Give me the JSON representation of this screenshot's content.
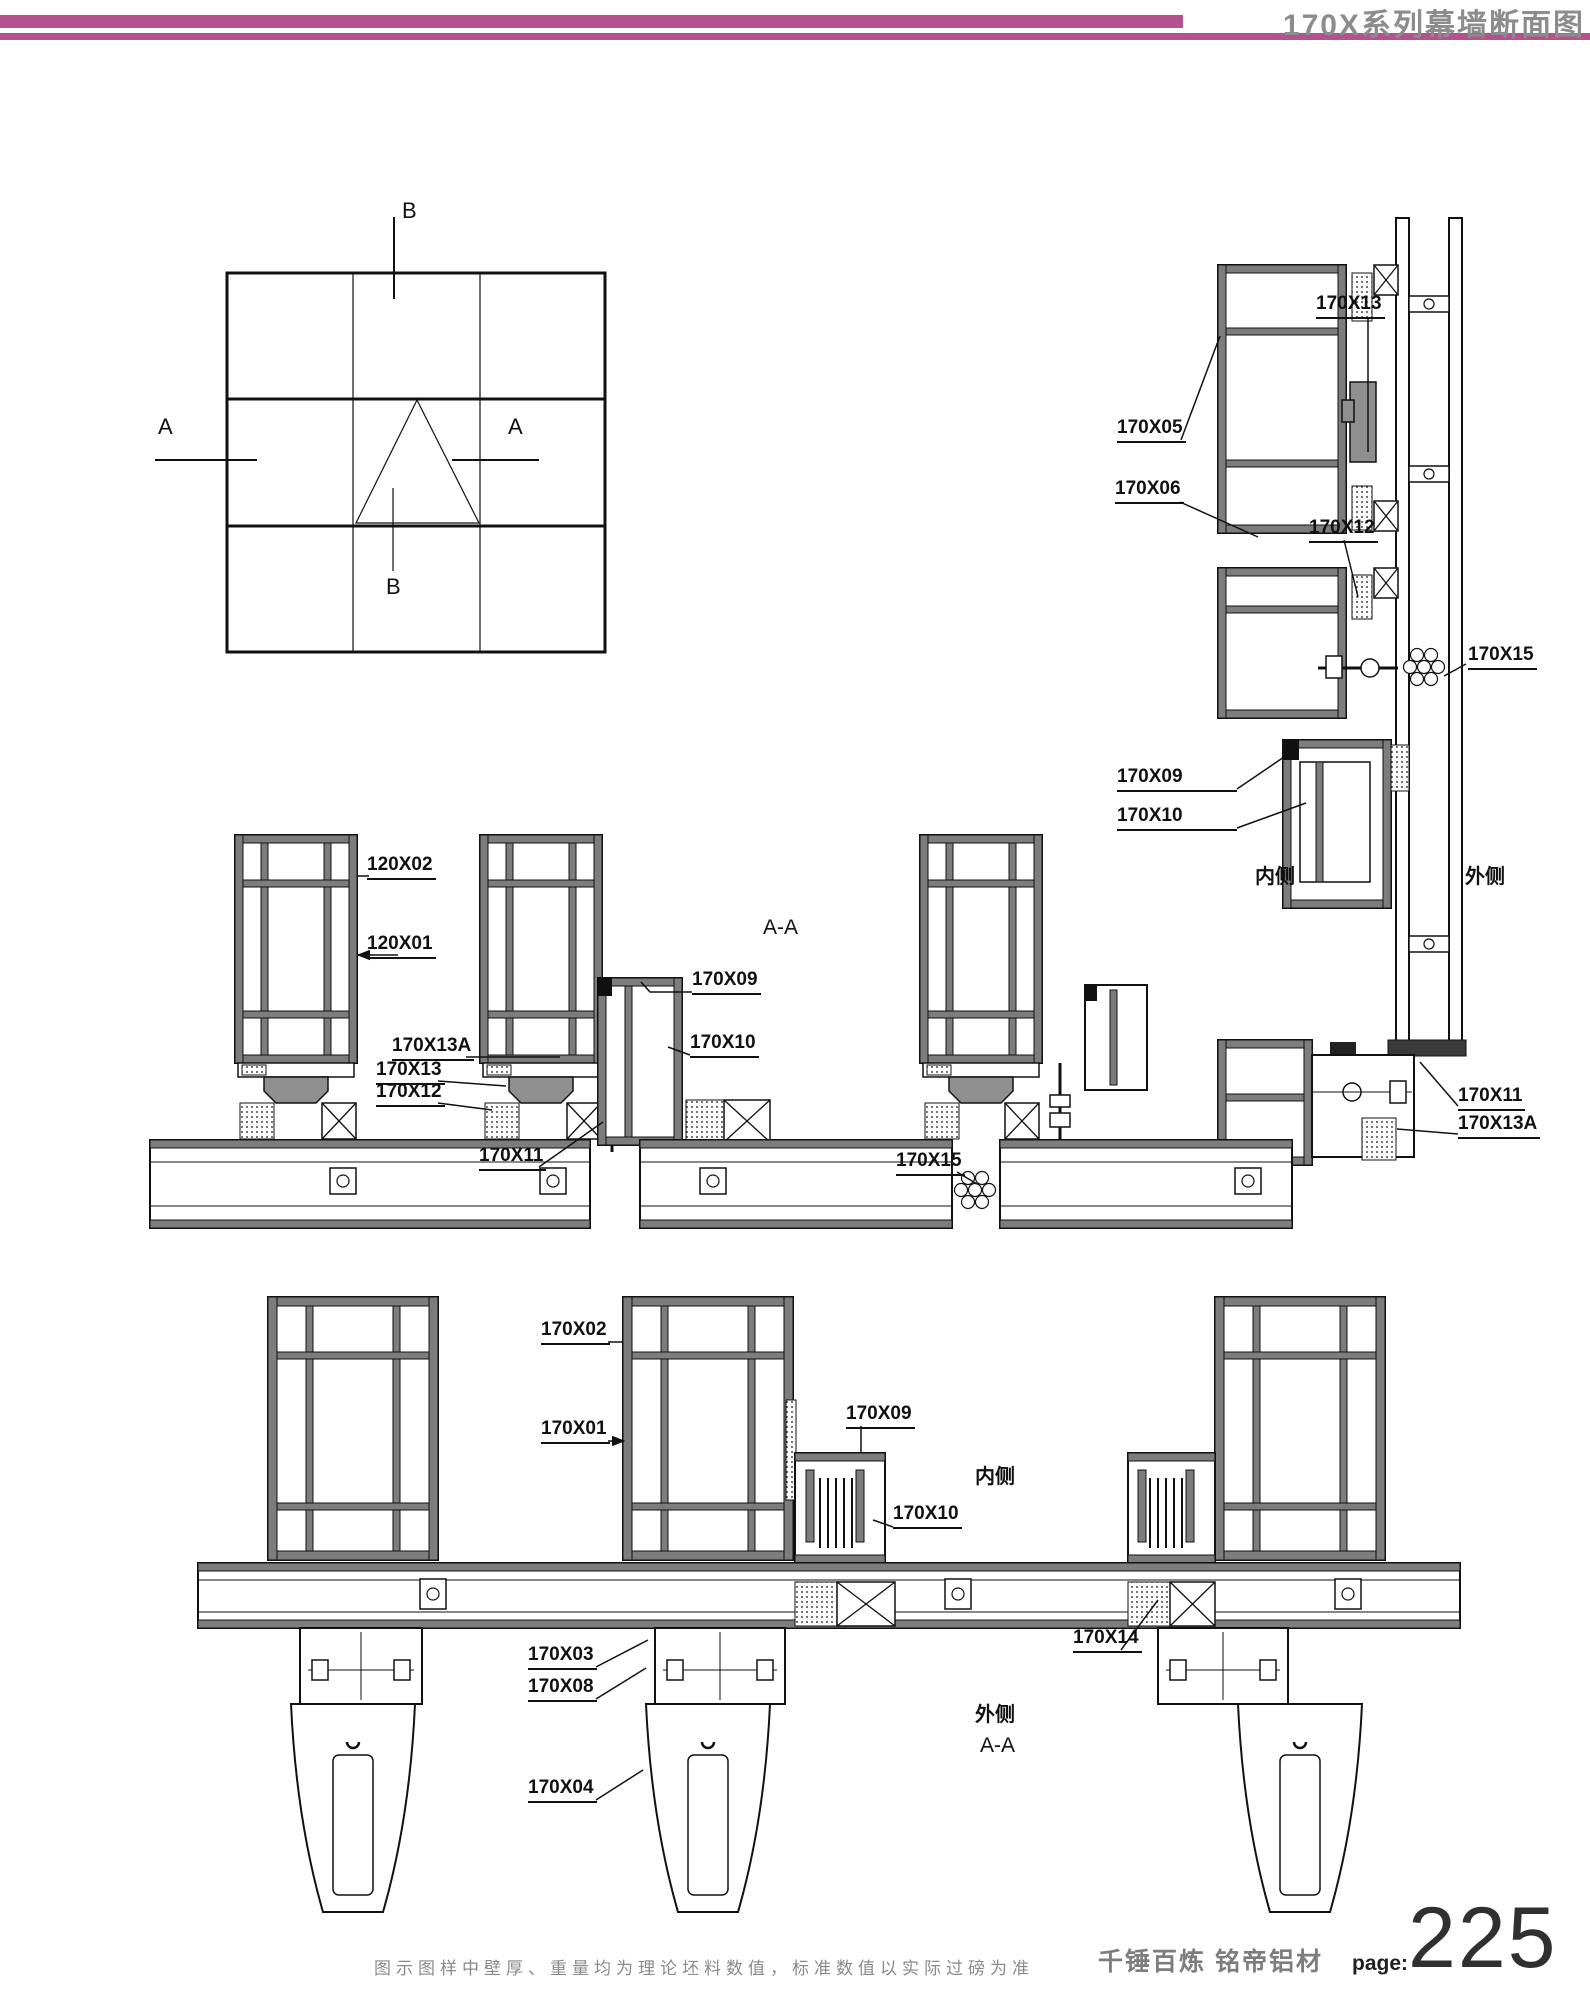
{
  "header": {
    "title": "170X系列幕墙断面图",
    "accent_color": "#b5518d"
  },
  "schematic": {
    "marker_a": "A",
    "marker_b": "B"
  },
  "detail_b": {
    "x13": "170X13",
    "x05": "170X05",
    "x06": "170X06",
    "x12": "170X12",
    "x15": "170X15",
    "x09": "170X09",
    "x10": "170X10",
    "inside": "内侧",
    "outside": "外侧",
    "x11": "170X11",
    "x13a": "170X13A"
  },
  "detail_mid": {
    "x02": "120X02",
    "x01": "120X01",
    "title": "A-A",
    "x09": "170X09",
    "x10": "170X10",
    "x13a": "170X13A",
    "x13": "170X13",
    "x12": "170X12",
    "x11": "170X11",
    "x15": "170X15"
  },
  "detail_bottom": {
    "x02": "170X02",
    "x01": "170X01",
    "x09": "170X09",
    "inside": "内侧",
    "x10": "170X10",
    "x03": "170X03",
    "x08": "170X08",
    "x14": "170X14",
    "outside": "外侧",
    "title": "A-A",
    "x04": "170X04"
  },
  "footer": {
    "disclaimer": "图示图样中壁厚、重量均为理论坯料数值，标准数值以实际过磅为准",
    "brand": "千锤百炼  铭帝铝材",
    "page_label": "page:",
    "page_number": "225"
  }
}
